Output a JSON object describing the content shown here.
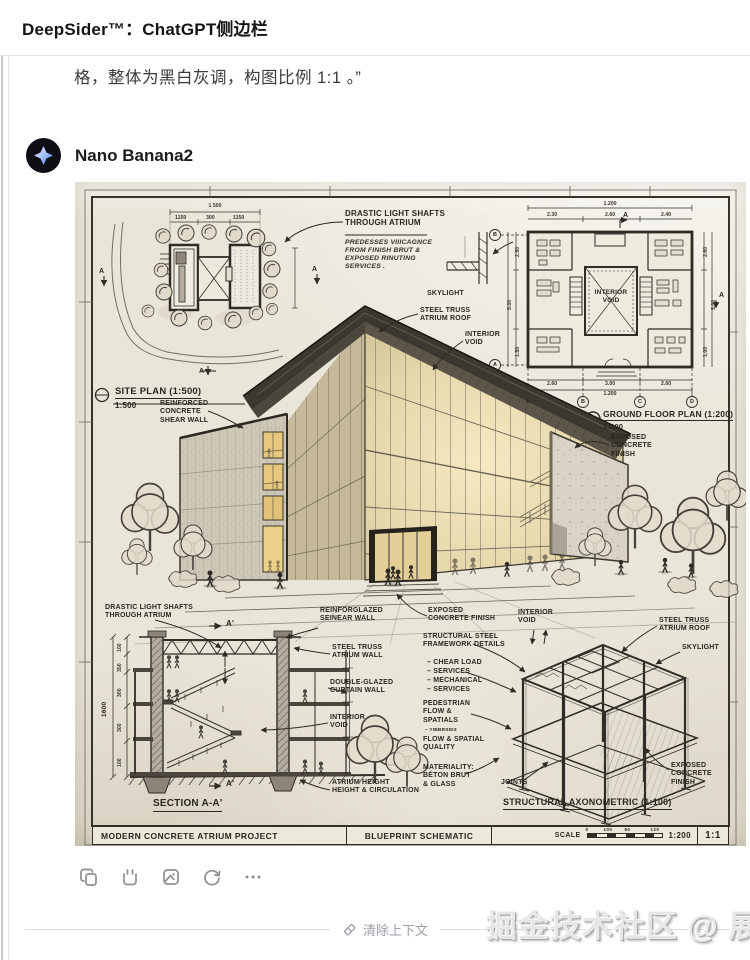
{
  "header": {
    "title": "DeepSider™：ChatGPT侧边栏"
  },
  "chat": {
    "user_text": "格，整体为黑白灰调，构图比例 1:1 。”",
    "assistant_name": "Nano Banana2"
  },
  "bp": {
    "site": {
      "title": "SITE PLAN (1:500)",
      "scale": "1:500",
      "overall": "1 500",
      "dims": [
        "1150",
        "300",
        "1150"
      ],
      "marker": "A"
    },
    "notes": {
      "heading": "DRASTIC LIGHT SHAFTS\nTHROUGH ATRIUM",
      "body": "PREDESSES VIIICAGNCE\nFROM FINISH BRUT &\nEXPOSED RINUTING\nSERVICES ."
    },
    "persp": {
      "skylight": "SKYLIGHT",
      "truss_roof": "STEEL TRUSS\nATRIUM ROOF",
      "interior_void": "INTERIOR\nVOID",
      "shear_wall": "REINFORCED\nCONCRETE\nSHEAR WALL",
      "exposed": "EXPOSED\nCONCRETE\nFINISH",
      "exposed2": "EXPOSED\nCONCRETE FINISH"
    },
    "gfp": {
      "title": "GROUND FLOOR PLAN (1:200)",
      "scale": "1:200",
      "void": "INTERIOR\nVOID",
      "top_overall": "1.200",
      "top": [
        "2.30",
        "2.60",
        "2.40"
      ],
      "bottom": [
        "2.60",
        "3.00",
        "2.60"
      ],
      "bottom_overall": "1.200",
      "left": [
        "2.50",
        "5.00",
        "1.50"
      ],
      "right": [
        "2.80",
        "5.00",
        "1.00"
      ],
      "grid": [
        "A",
        "B",
        "C",
        "D"
      ]
    },
    "section": {
      "title": "SECTION A-A'",
      "marker": "A'",
      "dims": [
        "100",
        "350",
        "300",
        "300",
        "100"
      ],
      "overall": "1600",
      "labels": {
        "drastic": "DRASTIC LIGHT SHAFTS\nTHROUGH ATRIUM",
        "reinforglazed": "REINFORGLAZED\nSEINEAR WALL",
        "truss_wall": "STEEL TRUSS\nATRIUM WALL",
        "double_glazed": "DOUBLE-GLAZED\nCURTAIN WALL",
        "void": "INTERIOR\nVOID",
        "atrium_height": "ATRIUM HEIGHT\nHEIGHT & CIRCULATION"
      }
    },
    "axo": {
      "title": "STRUCTURAL AXONOMETRIC (1:100)",
      "labels": {
        "exposed": "EXPOSED\nCONCRETE FINISH",
        "void": "INTERIOR\nVOID",
        "steel_frame": "STRUCTURAL STEEL\nFRAMEWORK DETAILS",
        "steel_items": "– CHEAR LOAD\n– SERVICES\n– MECHANICAL\n– SERVICES",
        "pedestrian": "PEDESTRIAN\nFLOW &\nSPATIALS",
        "pedestrian_note": "– YIBBRSID3",
        "flow": "FLOW & SPATIAL\nQUALITY",
        "materiality": "MATERIALITY:\nBÉTON BRUT\n& GLASS",
        "joints": "JOINTS",
        "truss_roof": "STEEL TRUSS\nATRIUM ROOF",
        "skylight": "SKYLIGHT",
        "exposed2": "EXPOSED\nCONCRETE\nFINISH"
      }
    },
    "tblock": {
      "project": "MODERN CONCRETE ATRIUM PROJECT",
      "doc": "BLUEPRINT SCHEMATIC",
      "scale_label": "SCALE",
      "ticks": [
        "0",
        "100",
        "50",
        "120"
      ],
      "scale_value": "1:200",
      "ratio": "1:1"
    }
  },
  "toolbar": {
    "icons": [
      "copy",
      "quote",
      "image",
      "regenerate",
      "more"
    ]
  },
  "footer": {
    "clear": "清除上下文"
  },
  "watermark": "掘金技术社区 @ 展菲",
  "colors": {
    "paper": "#e9e5d8",
    "ink": "#2f2c26",
    "glow": "#e8c87e",
    "accent_blue": "#3b6cf5"
  }
}
